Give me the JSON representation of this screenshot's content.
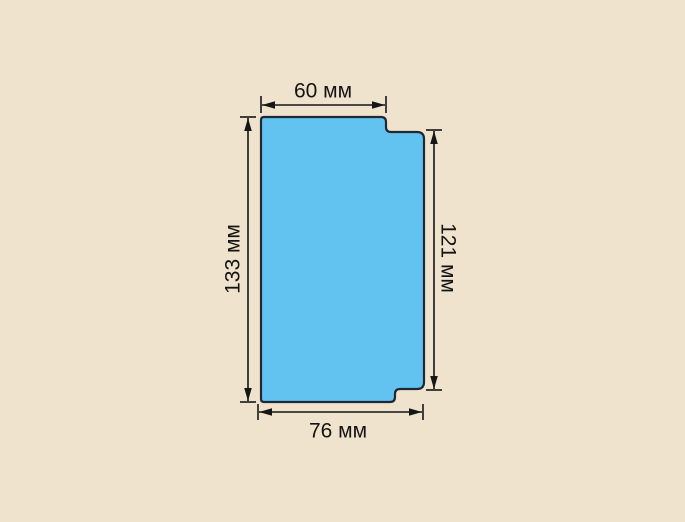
{
  "diagram": {
    "colors": {
      "background": "#f0e3cd",
      "shape_fill": "#63c3f0",
      "shape_outline": "#1d2a35",
      "dimension": "#161616"
    },
    "dimensions": {
      "top": {
        "label": "60 мм",
        "value": 60,
        "unit": "мм"
      },
      "left": {
        "label": "133 мм",
        "value": 133,
        "unit": "мм"
      },
      "right": {
        "label": "121 мм",
        "value": 121,
        "unit": "мм"
      },
      "bottom": {
        "label": "76 мм",
        "value": 76,
        "unit": "мм"
      }
    }
  }
}
